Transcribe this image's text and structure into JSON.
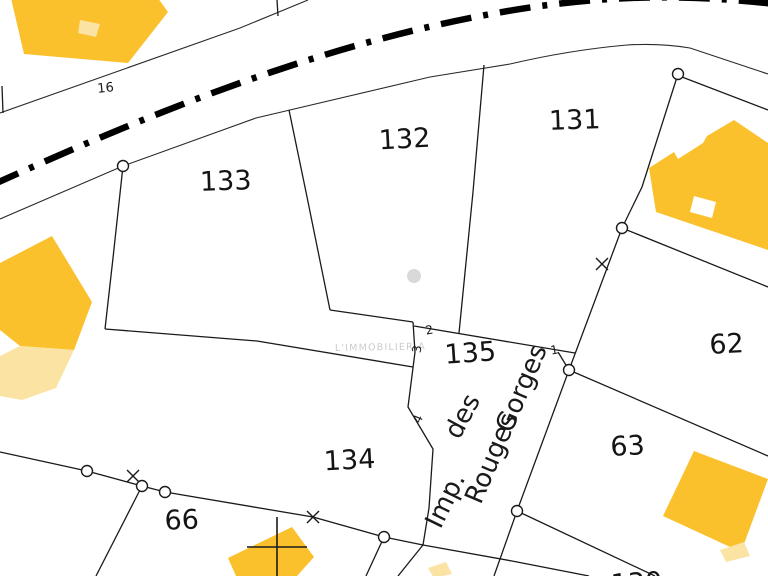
{
  "map": {
    "watermark_text": "L'IMMOBILIER A",
    "road_label": "16",
    "street_name_full": "Imp. des Rouges Gorges",
    "street_words": {
      "imp": "Imp.",
      "des": "des",
      "rouges": "Rouges",
      "gorges": "Gorges"
    },
    "parcel_labels": {
      "p131": "131",
      "p132": "132",
      "p133": "133",
      "p134": "134",
      "p135": "135",
      "p62": "62",
      "p63": "63",
      "p66": "66",
      "p130": "130"
    },
    "point_labels": {
      "n1": "1",
      "n2": "2",
      "n3": "3",
      "n4": "4"
    },
    "colors": {
      "background": "#FFFFFF",
      "building_fill": "#FBC12D",
      "building_light_fill": "#FBE3A3",
      "boundary_line": "#1A1A1A",
      "road_centerline": "#000000",
      "watermark": "#CBCBCB",
      "gray_dot": "#D9D9D9"
    }
  }
}
